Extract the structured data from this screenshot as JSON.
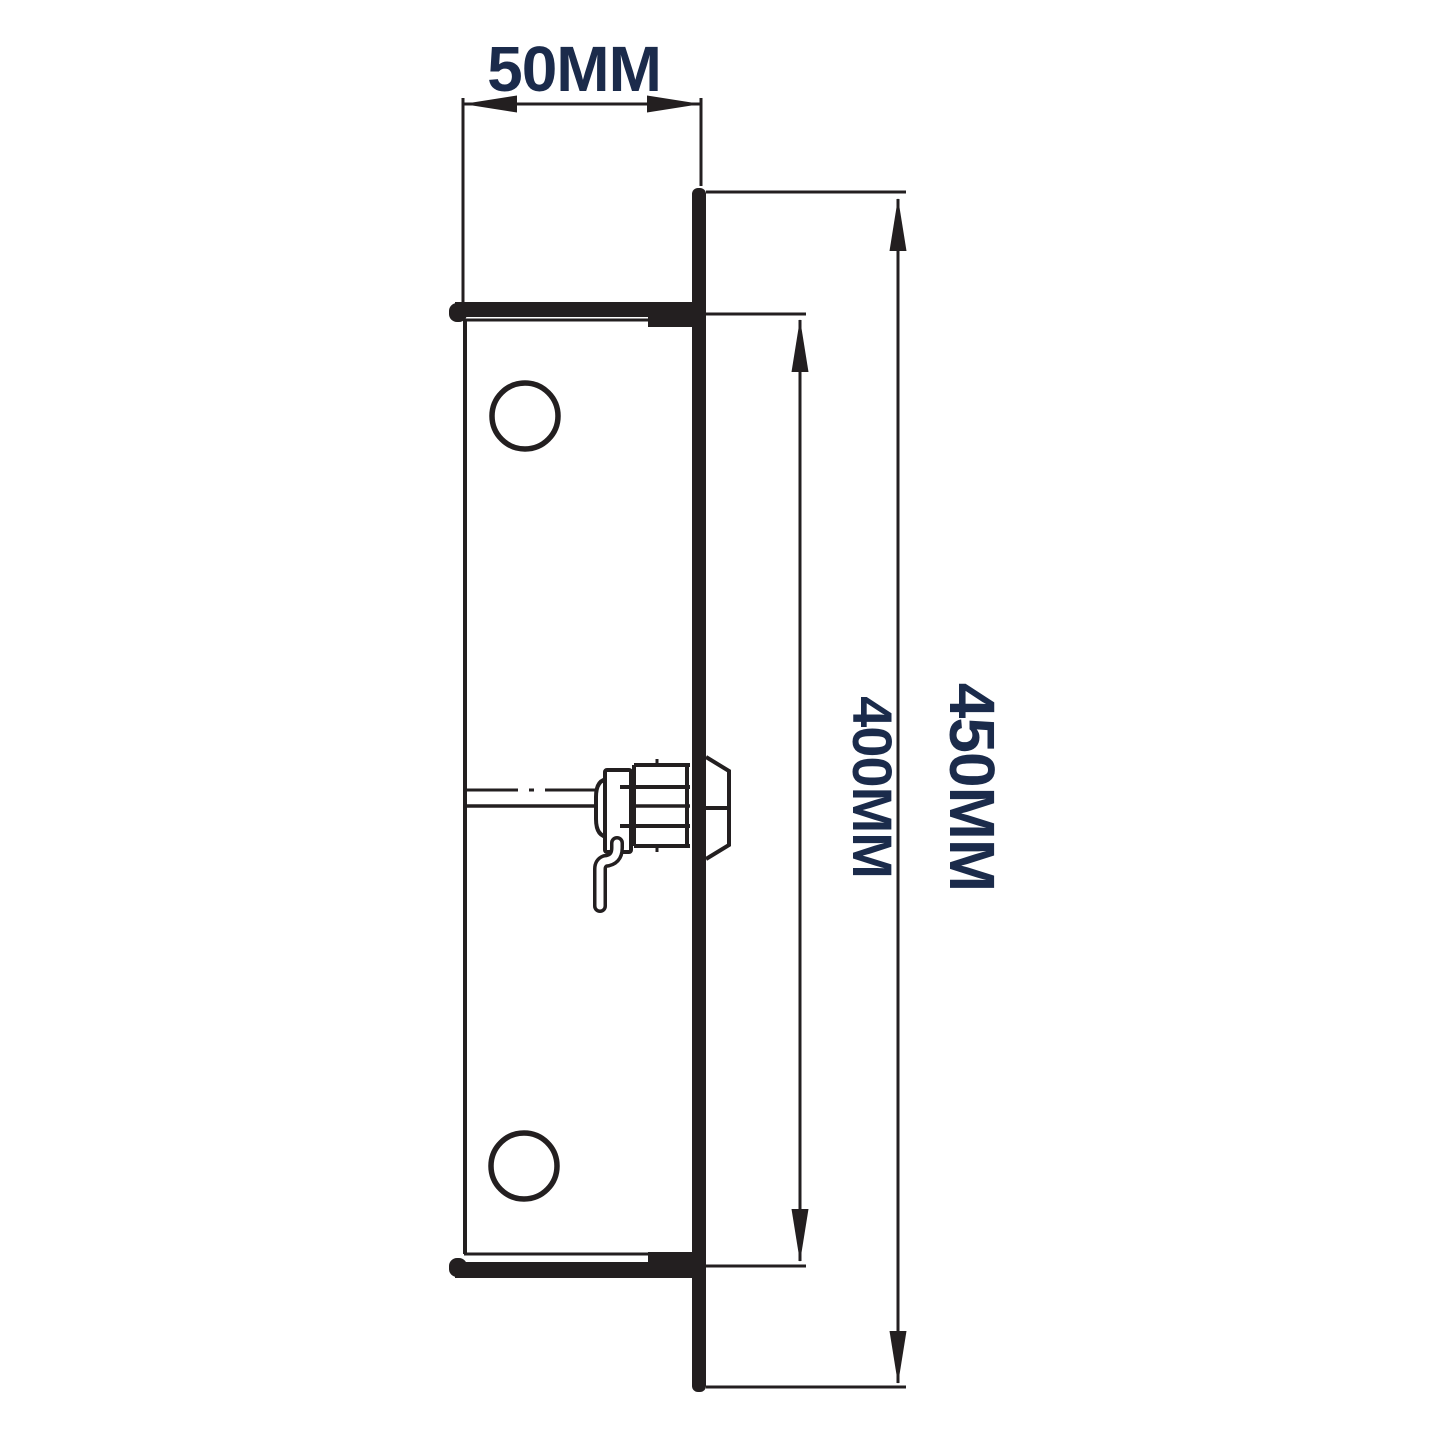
{
  "drawing": {
    "type": "technical-dimension-diagram",
    "subject": "cam-lock-faceplate-side-view",
    "dimensions": {
      "width_label": "50MM",
      "inner_height_label": "400MM",
      "overall_height_label": "450MM"
    },
    "colors": {
      "line": "#231f20",
      "label": "#1b2b4b",
      "bg": "#ffffff"
    }
  }
}
